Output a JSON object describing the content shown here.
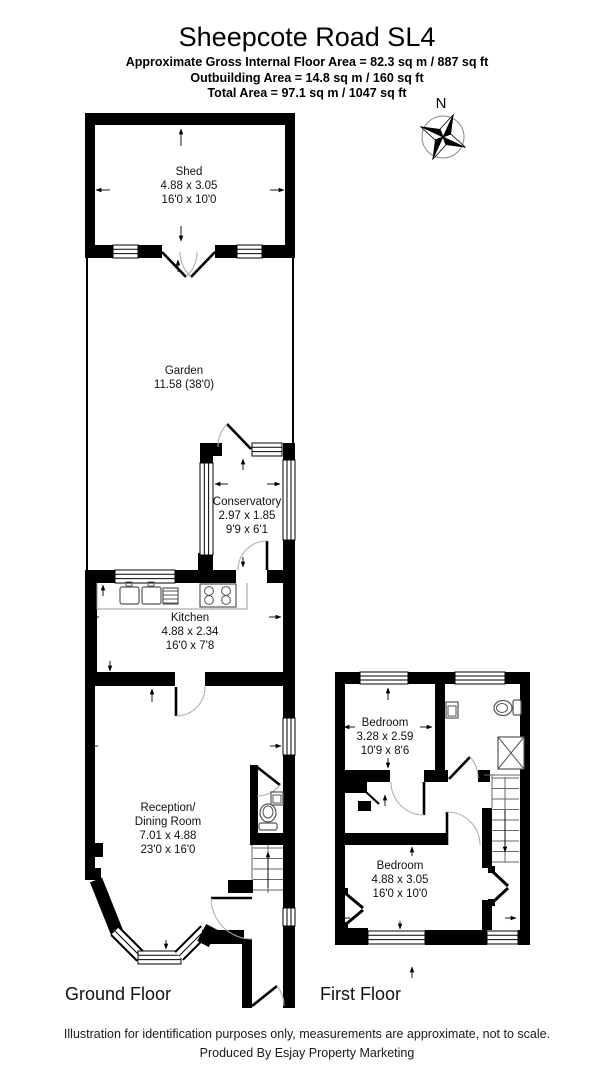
{
  "header": {
    "title": "Sheepcote Road SL4",
    "area_line1": "Approximate Gross Internal Floor Area = 82.3 sq m / 887 sq ft",
    "area_line2": "Outbuilding Area = 14.8 sq m / 160 sq ft",
    "area_line3": "Total Area = 97.1 sq m / 1047 sq ft"
  },
  "compass": {
    "north_label": "N"
  },
  "ground_floor": {
    "label": "Ground Floor",
    "rooms": {
      "shed": {
        "name": "Shed",
        "size_metric": "4.88 x 3.05",
        "size_imperial": "16'0 x 10'0"
      },
      "garden": {
        "name": "Garden",
        "size": "11.58 (38'0)"
      },
      "conservatory": {
        "name": "Conservatory",
        "size_metric": "2.97 x 1.85",
        "size_imperial": "9'9 x 6'1"
      },
      "kitchen": {
        "name": "Kitchen",
        "size_metric": "4.88 x 2.34",
        "size_imperial": "16'0 x 7'8"
      },
      "reception": {
        "name_line1": "Reception/",
        "name_line2": "Dining Room",
        "size_metric": "7.01 x 4.88",
        "size_imperial": "23'0 x 16'0"
      }
    }
  },
  "first_floor": {
    "label": "First Floor",
    "rooms": {
      "bedroom_front": {
        "name": "Bedroom",
        "size_metric": "3.28 x 2.59",
        "size_imperial": "10'9 x 8'6"
      },
      "bedroom_back": {
        "name": "Bedroom",
        "size_metric": "4.88 x 3.05",
        "size_imperial": "16'0 x 10'0"
      }
    }
  },
  "footer": {
    "disclaimer": "Illustration for identification purposes only, measurements are approximate, not to scale.",
    "credit": "Produced By Esjay Property Marketing"
  },
  "colors": {
    "wall": "#000000",
    "background": "#ffffff"
  }
}
